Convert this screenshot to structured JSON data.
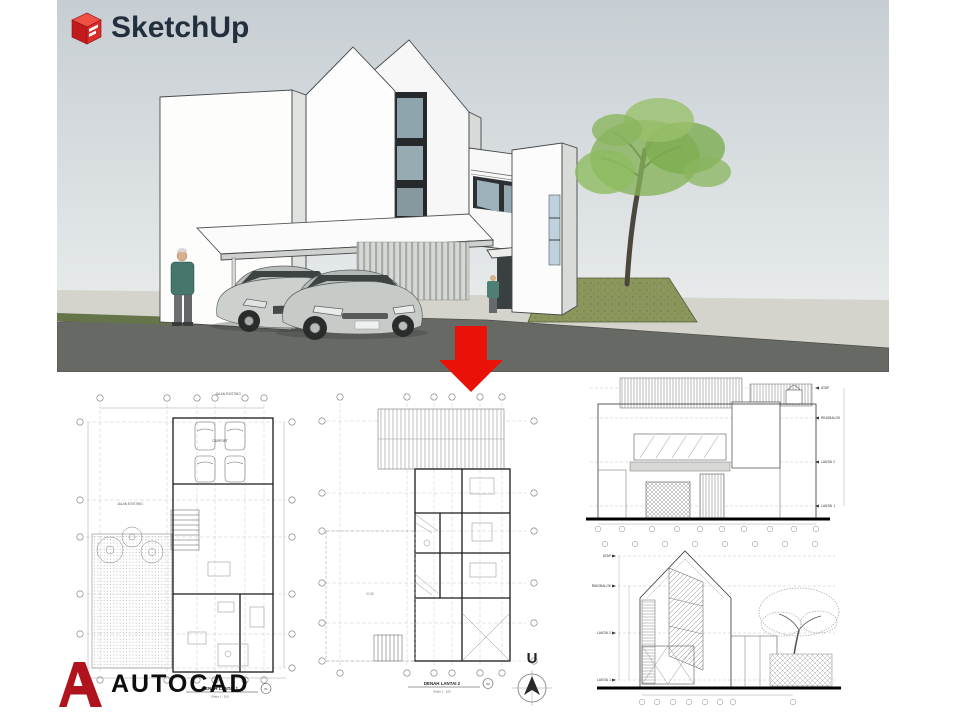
{
  "branding": {
    "sketchup": {
      "label": "SketchUp",
      "icon": "sketchup-cube-icon",
      "text_color": "#22303d",
      "cube_red": "#c8161d"
    },
    "autocad": {
      "label": "AUTOCAD",
      "icon": "autocad-a-icon",
      "text_color": "#0d0d0d",
      "a_red": "#b0121e"
    }
  },
  "colors": {
    "arrow_red": "#ea1208",
    "sky_top": "#c7ced3",
    "sky_bottom": "#eff1f1",
    "sidewalk": "#d4d4cc",
    "road": "#676964",
    "grass": "#66744a",
    "mound_green": "#8a975c",
    "tree_green": "#85b257",
    "drawing_line": "#444444"
  },
  "drawings": {
    "plan1": {
      "caption": "DENAH LANTAI 1",
      "sheet_no": "01",
      "scale_label": "Skala 1 : 100",
      "street_label_top": "JALAN EXISTING",
      "street_label_left": "JALAN EXISTING",
      "carport_label": "CARPORT"
    },
    "plan2": {
      "caption": "DENAH LANTAI 2",
      "sheet_no": "02",
      "scale_label": "Skala 1 : 100",
      "void_label": "VOID"
    },
    "elevation_front": {
      "levels": [
        "ATAP",
        "RINGBALOK",
        "LANTAI 2",
        "LANTAI 1"
      ]
    },
    "elevation_side": {
      "levels": [
        "ATAP",
        "RINGBALOK",
        "LANTAI 2",
        "LANTAI 1"
      ]
    },
    "compass_label": "U"
  }
}
